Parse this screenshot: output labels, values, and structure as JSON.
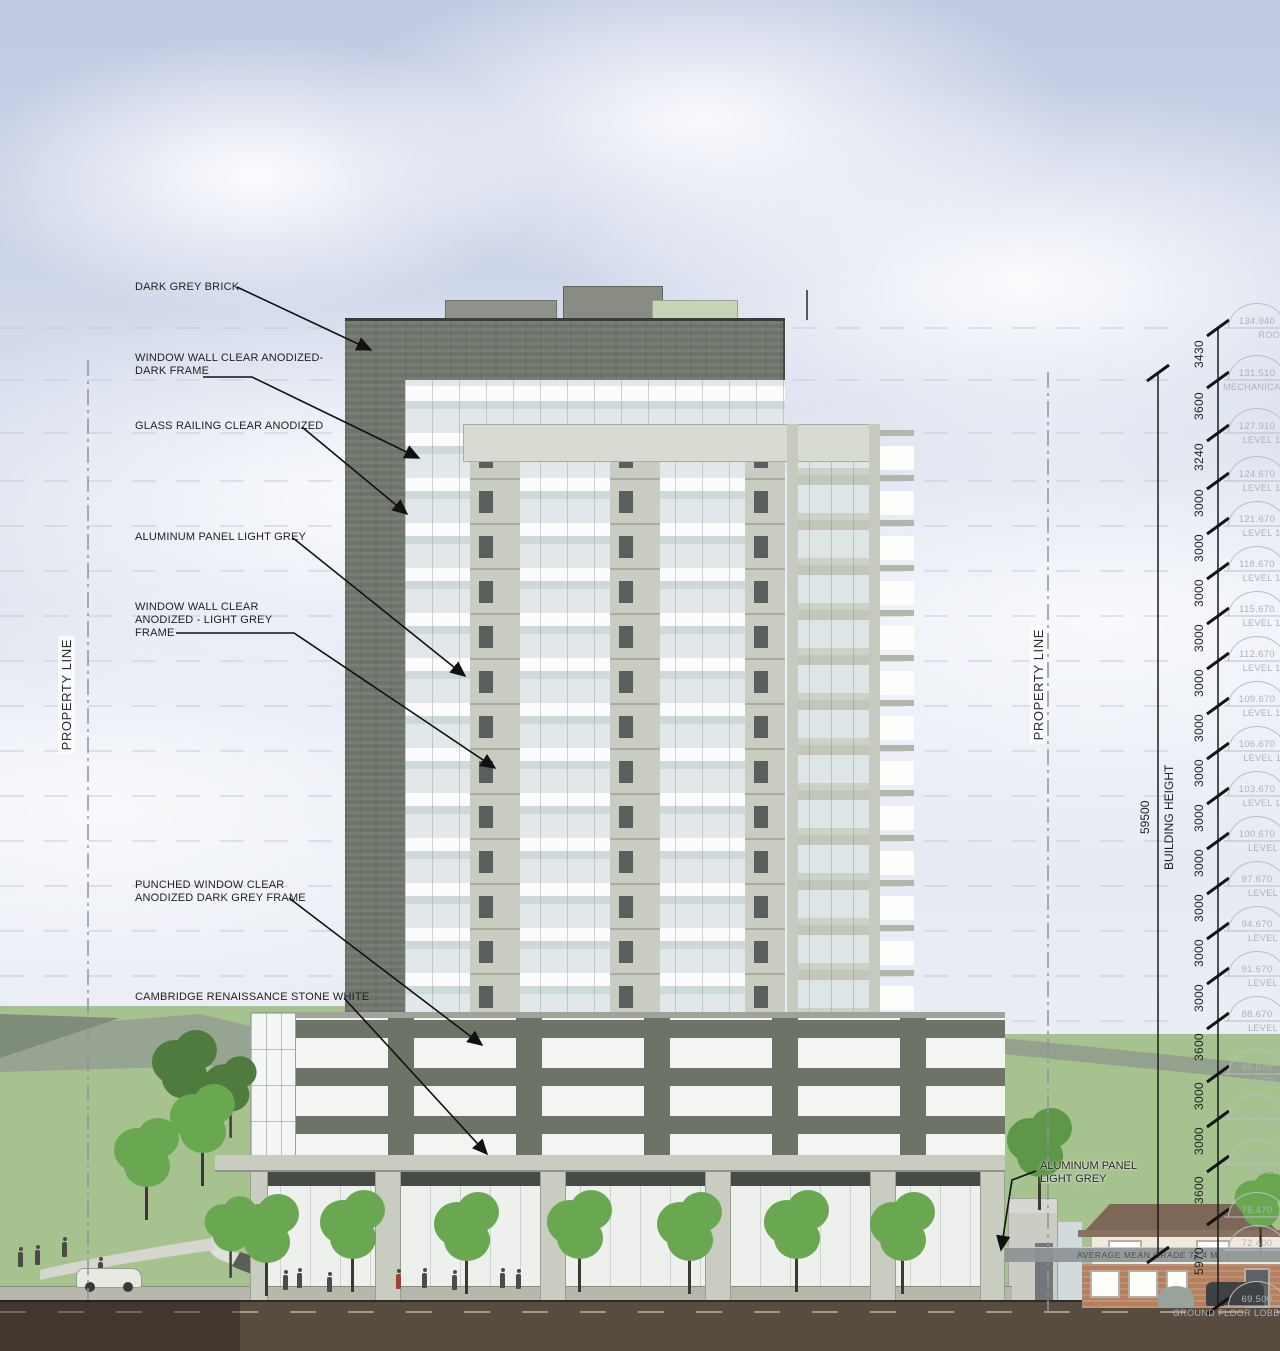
{
  "drawing": {
    "type_label": "Building East Elevation"
  },
  "callouts": [
    {
      "label": "DARK GREY BRICK"
    },
    {
      "label": "WINDOW WALL CLEAR ANODIZED-\nDARK FRAME"
    },
    {
      "label": "GLASS RAILING CLEAR ANODIZED"
    },
    {
      "label": "ALUMINUM PANEL LIGHT GREY"
    },
    {
      "label": "WINDOW WALL CLEAR\nANODIZED - LIGHT GREY\nFRAME"
    },
    {
      "label": "PUNCHED WINDOW CLEAR\nANODIZED DARK GREY FRAME"
    },
    {
      "label": "CAMBRIDGE RENAISSANCE STONE WHITE"
    }
  ],
  "right_callout": {
    "label": "ALUMINUM PANEL\nLIGHT GREY"
  },
  "property_lines": {
    "left": "PROPERTY LINE",
    "right": "PROPERTY LINE"
  },
  "building_height": {
    "value": "59500",
    "label": "BUILDING HEIGHT"
  },
  "grade_band": {
    "label": "AVERAGE MEAN GRADE 72.4 M"
  },
  "levels": [
    {
      "elevation": "134.940",
      "name": "ROOF"
    },
    {
      "elevation": "131.510",
      "name": "MECHANICAL"
    },
    {
      "elevation": "127.910",
      "name": "LEVEL 18"
    },
    {
      "elevation": "124.670",
      "name": "LEVEL 17"
    },
    {
      "elevation": "121.670",
      "name": "LEVEL 16"
    },
    {
      "elevation": "118.670",
      "name": "LEVEL 15"
    },
    {
      "elevation": "115.670",
      "name": "LEVEL 14"
    },
    {
      "elevation": "112.670",
      "name": "LEVEL 13"
    },
    {
      "elevation": "109.670",
      "name": "LEVEL 12"
    },
    {
      "elevation": "106.670",
      "name": "LEVEL 11"
    },
    {
      "elevation": "103.670",
      "name": "LEVEL 10"
    },
    {
      "elevation": "100.670",
      "name": "LEVEL 9"
    },
    {
      "elevation": "97.670",
      "name": "LEVEL 8"
    },
    {
      "elevation": "94.670",
      "name": "LEVEL 7"
    },
    {
      "elevation": "91.670",
      "name": "LEVEL 6"
    },
    {
      "elevation": "88.670",
      "name": "LEVEL 5"
    },
    {
      "elevation": "85.070",
      "name": "LEVEL 4"
    },
    {
      "elevation": "82.070",
      "name": "LEVEL 3"
    },
    {
      "elevation": "79.070",
      "name": "LEVEL 2"
    },
    {
      "elevation": "75.470",
      "name": ""
    },
    {
      "elevation": "72.400",
      "name": ""
    },
    {
      "elevation": "69.500",
      "name": "GROUND FLOOR LOBBY"
    }
  ],
  "dims": [
    "3430",
    "3600",
    "3240",
    "3000",
    "3000",
    "3000",
    "3000",
    "3000",
    "3000",
    "3000",
    "3000",
    "3000",
    "3000",
    "3000",
    "3000",
    "3600",
    "3000",
    "3000",
    "3600",
    "5970"
  ],
  "colors": {
    "sky_top": "#bfc9e2",
    "dark_grey_brick": "#6f746a",
    "aluminum_panel_light_grey": "#c9cdc1",
    "grass": "#a6c28e",
    "soil": "#584b40",
    "house_roof": "#7d6757",
    "tree_green": "#69a851",
    "annotation_ink": "#1a1a1a",
    "bubble_grey": "#adb2ba"
  }
}
